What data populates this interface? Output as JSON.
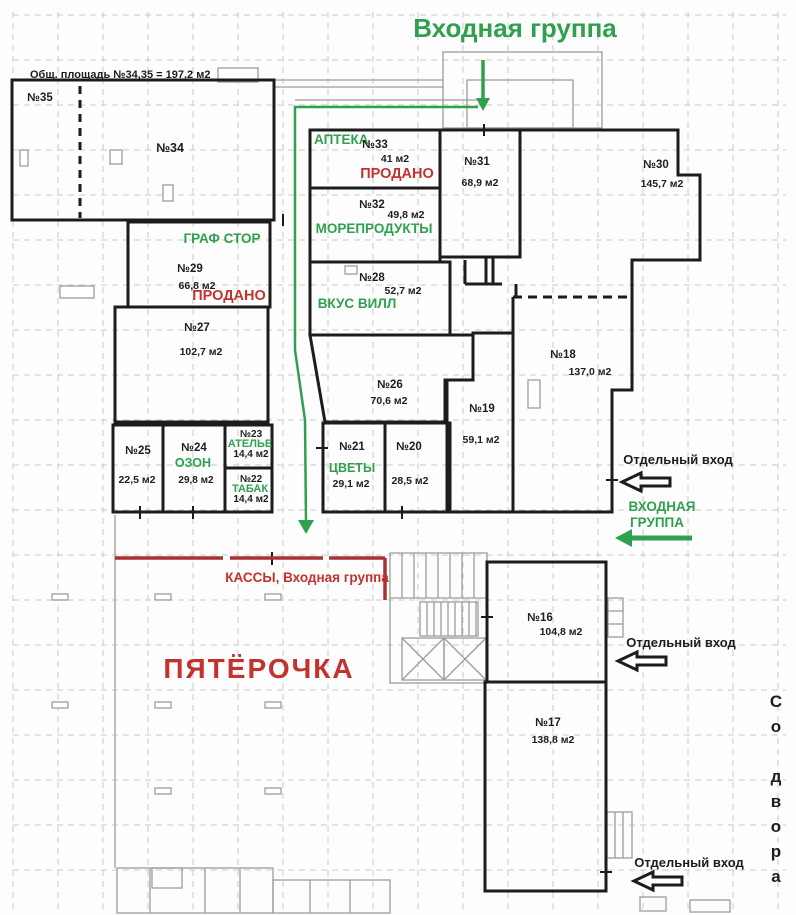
{
  "labels": {
    "entrance_top": "Входная группа",
    "total_area_note": "Общ. площадь №34,35 = 197,2 м2",
    "kassy": "КАССЫ, Входная группа",
    "pyaterochka": "ПЯТЁРОЧКА",
    "entrance_right_1": "ВХОДНАЯ",
    "entrance_right_2": "ГРУППА",
    "separate_entrance": "Отдельный вход",
    "from_yard": "Со двора"
  },
  "units": [
    {
      "id": "35",
      "number": "№35",
      "area": "",
      "tenant": "",
      "status": ""
    },
    {
      "id": "34",
      "number": "№34",
      "area": "",
      "tenant": "",
      "status": ""
    },
    {
      "id": "33",
      "number": "№33",
      "area": "41 м2",
      "tenant": "АПТЕКА",
      "status": "ПРОДАНО"
    },
    {
      "id": "32",
      "number": "№32",
      "area": "49,8 м2",
      "tenant": "МОРЕПРОДУКТЫ",
      "status": ""
    },
    {
      "id": "31",
      "number": "№31",
      "area": "68,9 м2",
      "tenant": "",
      "status": ""
    },
    {
      "id": "30",
      "number": "№30",
      "area": "145,7 м2",
      "tenant": "",
      "status": ""
    },
    {
      "id": "29",
      "number": "№29",
      "area": "66,8 м2",
      "tenant": "ГРАФ СТОР",
      "status": "ПРОДАНО"
    },
    {
      "id": "28",
      "number": "№28",
      "area": "52,7 м2",
      "tenant": "ВКУС ВИЛЛ",
      "status": ""
    },
    {
      "id": "27",
      "number": "№27",
      "area": "102,7 м2",
      "tenant": "",
      "status": ""
    },
    {
      "id": "26",
      "number": "№26",
      "area": "70,6 м2",
      "tenant": "",
      "status": ""
    },
    {
      "id": "25",
      "number": "№25",
      "area": "22,5 м2",
      "tenant": "",
      "status": ""
    },
    {
      "id": "24",
      "number": "№24",
      "area": "29,8 м2",
      "tenant": "ОЗОН",
      "status": ""
    },
    {
      "id": "23",
      "number": "№23",
      "area": "14,4 м2",
      "tenant": "АТЕЛЬЕ",
      "status": ""
    },
    {
      "id": "22",
      "number": "№22",
      "area": "14,4 м2",
      "tenant": "ТАБАК",
      "status": ""
    },
    {
      "id": "21",
      "number": "№21",
      "area": "29,1 м2",
      "tenant": "ЦВЕТЫ",
      "status": ""
    },
    {
      "id": "20",
      "number": "№20",
      "area": "28,5 м2",
      "tenant": "",
      "status": ""
    },
    {
      "id": "19",
      "number": "№19",
      "area": "59,1 м2",
      "tenant": "",
      "status": ""
    },
    {
      "id": "18",
      "number": "№18",
      "area": "137,0 м2",
      "tenant": "",
      "status": ""
    },
    {
      "id": "16",
      "number": "№16",
      "area": "104,8 м2",
      "tenant": "",
      "status": ""
    },
    {
      "id": "17",
      "number": "№17",
      "area": "138,8 м2",
      "tenant": "",
      "status": ""
    }
  ],
  "colors": {
    "green": "#2fa04e",
    "red": "#c2322e",
    "redline": "#a83232",
    "wall": "#1c1c1c",
    "grid": "#c9c9c9",
    "gray": "#9d9d9d"
  }
}
